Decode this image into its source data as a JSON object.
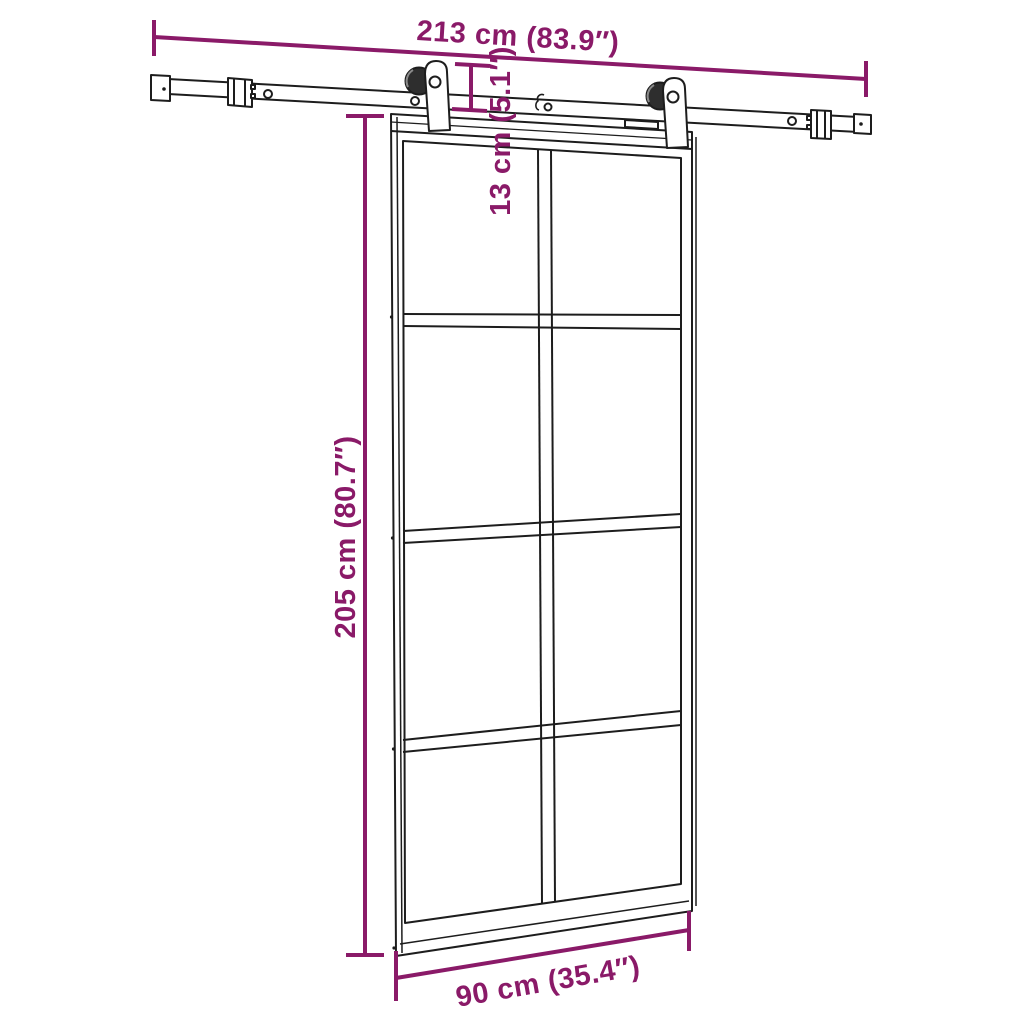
{
  "diagram": {
    "kind": "product-dimension-diagram",
    "subject": "sliding-barn-door-with-glass-panels-and-rail-hardware",
    "dimensions": {
      "rail_length": "213 cm (83.9″)",
      "door_height": "205 cm (80.7″)",
      "hanger_drop": "13 cm (5.1″)",
      "door_width": "90 cm (35.4″)"
    },
    "door": {
      "panel_columns": 2,
      "panel_rows": 4,
      "panel_count": 8,
      "hanger_count": 2
    },
    "colors": {
      "dimension_accent": "#8a1a68",
      "outline": "#1d1d1d",
      "wheel_fill": "#2e2e2e",
      "background": "#ffffff"
    }
  }
}
